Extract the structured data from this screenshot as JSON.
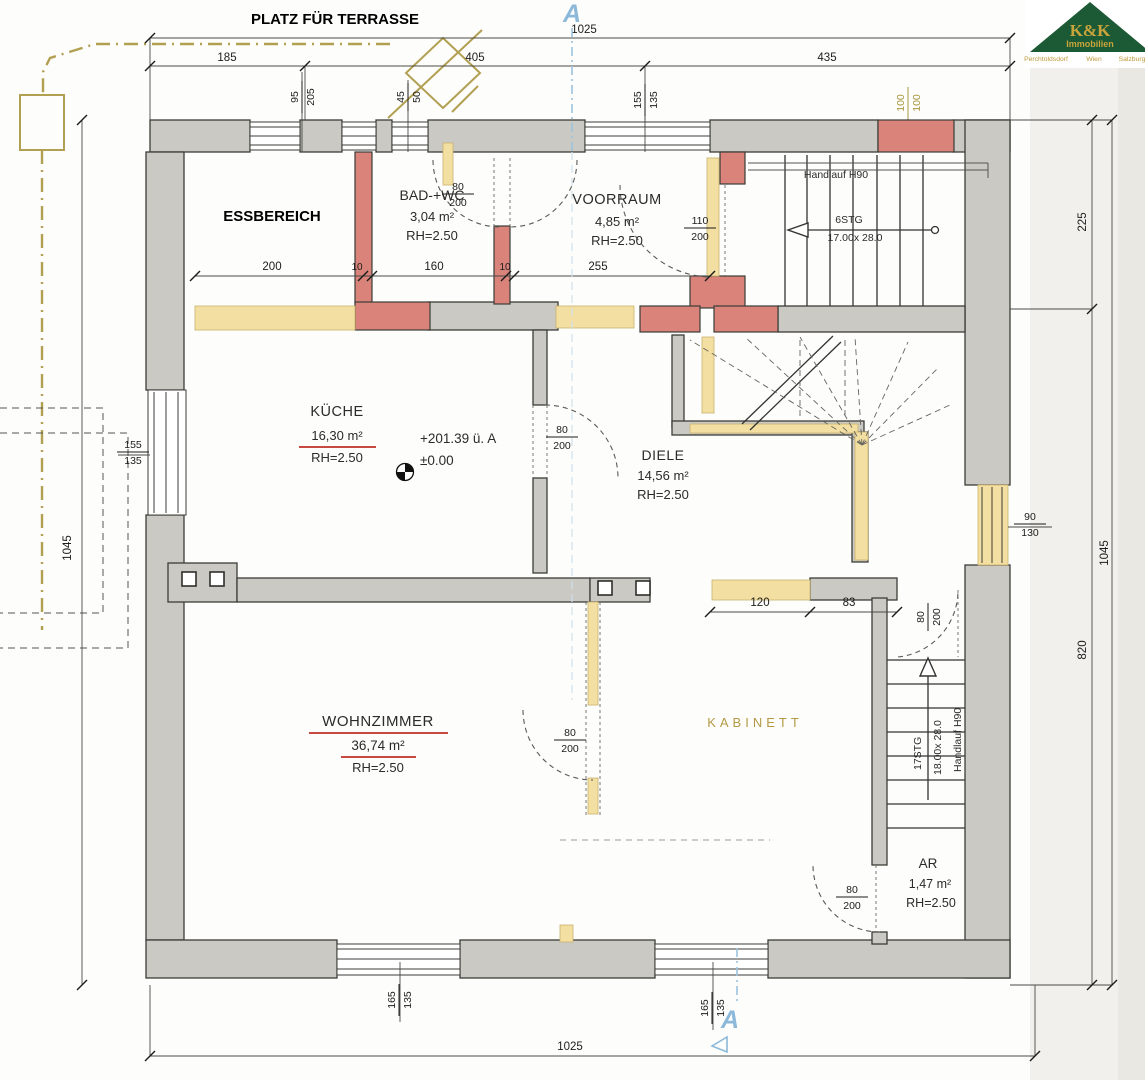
{
  "annotations": {
    "terrace": "PLATZ FÜR TERRASSE",
    "essbereich": "ESSBEREICH",
    "level_abs": "+201.39 ü. A",
    "level_rel": "±0.00",
    "section_top": "A",
    "section_bottom": "A"
  },
  "rooms": {
    "bad": {
      "name": "BAD-+WC",
      "area": "3,04 m²",
      "rh": "RH=2.50"
    },
    "voorraum": {
      "name": "VOORRAUM",
      "area": "4,85 m²",
      "rh": "RH=2.50"
    },
    "kueche": {
      "name": "KÜCHE",
      "area": "16,30 m²",
      "rh": "RH=2.50"
    },
    "diele": {
      "name": "DIELE",
      "area": "14,56 m²",
      "rh": "RH=2.50"
    },
    "wohnzimmer": {
      "name": "WOHNZIMMER",
      "area": "36,74 m²",
      "rh": "RH=2.50"
    },
    "kabinett": {
      "name": "KABINETT"
    },
    "ar": {
      "name": "AR",
      "area": "1,47 m²",
      "rh": "RH=2.50"
    }
  },
  "stairs": {
    "upper": {
      "steps": "6STG",
      "tread": "17.00x 28.0",
      "handrail": "Handlauf H90"
    },
    "lower": {
      "steps": "17STG",
      "tread": "18.00x 28.0",
      "handrail": "Handlauf H90"
    }
  },
  "dims": {
    "top_total": "1025",
    "top_1": "185",
    "top_2": "405",
    "top_3": "435",
    "bottom_total": "1025",
    "left_total": "1045",
    "right_total": "1045",
    "right_upper": "225",
    "right_lower": "820",
    "inner_1": "200",
    "inner_2": "10",
    "inner_3": "160",
    "inner_4": "10",
    "inner_5": "255",
    "kab_1": "120",
    "kab_2": "83"
  },
  "openings": {
    "win_95": {
      "w": "95",
      "h": "205"
    },
    "win_45": {
      "w": "45",
      "h": "50"
    },
    "win_155_top": {
      "w": "155",
      "h": "135"
    },
    "chimney": {
      "w": "100",
      "h": "100"
    },
    "door_bad": {
      "w": "80",
      "h": "200"
    },
    "door_voorraum": {
      "w": "110",
      "h": "200"
    },
    "door_kueche": {
      "w": "80",
      "h": "200"
    },
    "win_155_left": {
      "w": "155",
      "h": "135"
    },
    "win_90_right": {
      "w": "90",
      "h": "130"
    },
    "door_wohnz": {
      "w": "80",
      "h": "200"
    },
    "door_stair": {
      "w": "80",
      "h": "200"
    },
    "door_ar": {
      "w": "80",
      "h": "200"
    },
    "win_165_l": {
      "w": "165",
      "h": "135"
    },
    "win_165_r": {
      "w": "165",
      "h": "135"
    }
  },
  "logo": {
    "brand": "K&K",
    "division": "Immobilien",
    "locations": [
      "Perchtoldsdorf",
      "Wien",
      "Salzburg"
    ]
  },
  "colors": {
    "wall_existing": "#cac9c3",
    "wall_new": "#d9837b",
    "wall_demolition": "#f3dfa2",
    "underline_red": "#c7493f",
    "section_blue": "#8cb9da",
    "olive": "#b2a052",
    "logo_green": "#1b5a34",
    "logo_gold": "#c9a43c"
  }
}
